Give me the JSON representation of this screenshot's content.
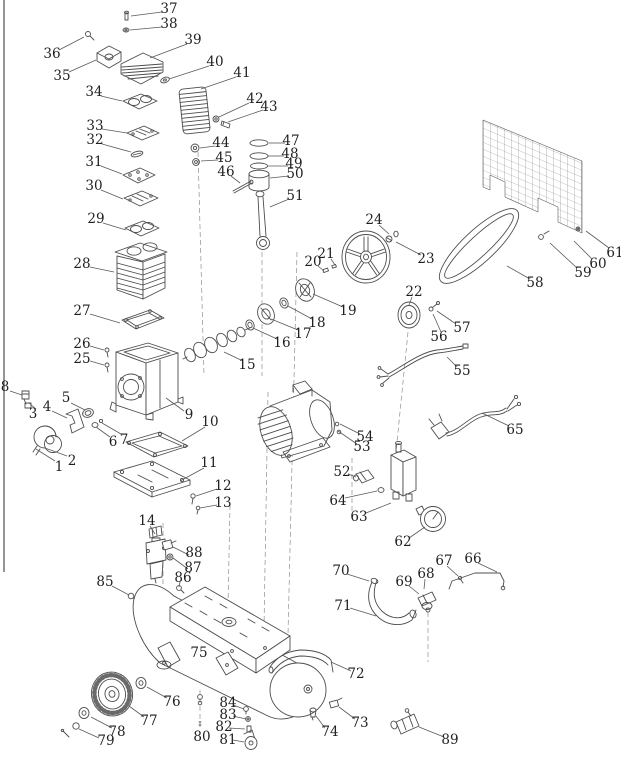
{
  "page": {
    "background": "#ffffff",
    "line_color": "#4d4d4d",
    "label_color": "#1f1f1f",
    "dash_color": "#8f8f8f",
    "border_color": "#7a7a7a"
  },
  "diagram": {
    "type": "exploded-parts-diagram",
    "subject": "air compressor parts breakdown",
    "part_count": 89,
    "labels": [
      {
        "n": "1",
        "x": 59,
        "y": 467,
        "leader": [
          55,
          461,
          36,
          449
        ]
      },
      {
        "n": "2",
        "x": 72,
        "y": 461,
        "leader": [
          67,
          456,
          45,
          448
        ]
      },
      {
        "n": "3",
        "x": 33,
        "y": 414,
        "leader": [
          36,
          409,
          29,
          403
        ]
      },
      {
        "n": "4",
        "x": 47,
        "y": 407,
        "leader": [
          52,
          411,
          67,
          418
        ]
      },
      {
        "n": "5",
        "x": 66,
        "y": 398,
        "leader": [
          71,
          403,
          85,
          410
        ]
      },
      {
        "n": "6",
        "x": 113,
        "y": 442,
        "leader": [
          110,
          437,
          96,
          427
        ]
      },
      {
        "n": "7",
        "x": 124,
        "y": 440,
        "leader": [
          121,
          434,
          102,
          423
        ]
      },
      {
        "n": "8",
        "x": 5,
        "y": 387,
        "leader": [
          10,
          391,
          22,
          395
        ]
      },
      {
        "n": "9",
        "x": 189,
        "y": 415,
        "leader": [
          184,
          411,
          166,
          398
        ]
      },
      {
        "n": "10",
        "x": 210,
        "y": 422,
        "leader": [
          205,
          427,
          182,
          441
        ]
      },
      {
        "n": "11",
        "x": 209,
        "y": 463,
        "leader": [
          204,
          468,
          180,
          481
        ]
      },
      {
        "n": "12",
        "x": 223,
        "y": 486,
        "leader": [
          217,
          489,
          196,
          496
        ]
      },
      {
        "n": "13",
        "x": 223,
        "y": 503,
        "leader": [
          217,
          505,
          200,
          508
        ]
      },
      {
        "n": "14",
        "x": 147,
        "y": 521,
        "leader": [
          150,
          526,
          155,
          534
        ]
      },
      {
        "n": "15",
        "x": 247,
        "y": 365,
        "leader": [
          243,
          361,
          224,
          352
        ]
      },
      {
        "n": "16",
        "x": 282,
        "y": 343,
        "leader": [
          277,
          339,
          253,
          328
        ]
      },
      {
        "n": "17",
        "x": 303,
        "y": 334,
        "leader": [
          298,
          330,
          271,
          319
        ]
      },
      {
        "n": "18",
        "x": 317,
        "y": 323,
        "leader": [
          312,
          319,
          288,
          306
        ]
      },
      {
        "n": "19",
        "x": 348,
        "y": 311,
        "leader": [
          343,
          307,
          313,
          294
        ]
      },
      {
        "n": "20",
        "x": 313,
        "y": 262,
        "leader": [
          318,
          266,
          324,
          271
        ]
      },
      {
        "n": "21",
        "x": 326,
        "y": 254,
        "leader": [
          331,
          259,
          335,
          265
        ]
      },
      {
        "n": "22",
        "x": 414,
        "y": 292,
        "leader": [
          412,
          297,
          409,
          305
        ]
      },
      {
        "n": "23",
        "x": 426,
        "y": 259,
        "leader": [
          421,
          255,
          396,
          242
        ]
      },
      {
        "n": "24",
        "x": 374,
        "y": 220,
        "leader": [
          379,
          225,
          389,
          234
        ]
      },
      {
        "n": "25",
        "x": 82,
        "y": 359,
        "leader": [
          90,
          361,
          104,
          365
        ]
      },
      {
        "n": "26",
        "x": 82,
        "y": 344,
        "leader": [
          90,
          346,
          104,
          350
        ]
      },
      {
        "n": "27",
        "x": 82,
        "y": 311,
        "leader": [
          90,
          314,
          120,
          323
        ]
      },
      {
        "n": "28",
        "x": 82,
        "y": 264,
        "leader": [
          90,
          267,
          114,
          272
        ]
      },
      {
        "n": "29",
        "x": 96,
        "y": 219,
        "leader": [
          103,
          223,
          126,
          230
        ]
      },
      {
        "n": "30",
        "x": 94,
        "y": 186,
        "leader": [
          101,
          190,
          123,
          199
        ]
      },
      {
        "n": "31",
        "x": 94,
        "y": 162,
        "leader": [
          101,
          166,
          122,
          174
        ]
      },
      {
        "n": "32",
        "x": 95,
        "y": 140,
        "leader": [
          102,
          144,
          131,
          152
        ]
      },
      {
        "n": "33",
        "x": 95,
        "y": 126,
        "leader": [
          102,
          129,
          127,
          133
        ]
      },
      {
        "n": "34",
        "x": 94,
        "y": 92,
        "leader": [
          101,
          96,
          122,
          101
        ]
      },
      {
        "n": "35",
        "x": 62,
        "y": 76,
        "leader": [
          69,
          72,
          96,
          60
        ]
      },
      {
        "n": "36",
        "x": 52,
        "y": 54,
        "leader": [
          59,
          50,
          84,
          37
        ]
      },
      {
        "n": "37",
        "x": 169,
        "y": 9,
        "leader": [
          162,
          12,
          131,
          16
        ]
      },
      {
        "n": "38",
        "x": 169,
        "y": 24,
        "leader": [
          162,
          27,
          130,
          30
        ]
      },
      {
        "n": "39",
        "x": 193,
        "y": 40,
        "leader": [
          187,
          44,
          150,
          58
        ]
      },
      {
        "n": "40",
        "x": 215,
        "y": 62,
        "leader": [
          209,
          66,
          169,
          79
        ]
      },
      {
        "n": "41",
        "x": 242,
        "y": 73,
        "leader": [
          236,
          77,
          201,
          89
        ]
      },
      {
        "n": "42",
        "x": 255,
        "y": 99,
        "leader": [
          249,
          103,
          219,
          117
        ]
      },
      {
        "n": "43",
        "x": 269,
        "y": 107,
        "leader": [
          263,
          110,
          228,
          122
        ]
      },
      {
        "n": "44",
        "x": 221,
        "y": 143,
        "leader": [
          215,
          146,
          200,
          148
        ]
      },
      {
        "n": "45",
        "x": 224,
        "y": 158,
        "leader": [
          218,
          160,
          201,
          161
        ]
      },
      {
        "n": "46",
        "x": 226,
        "y": 172,
        "leader": [
          231,
          176,
          240,
          183
        ]
      },
      {
        "n": "47",
        "x": 291,
        "y": 141,
        "leader": [
          285,
          143,
          269,
          143
        ]
      },
      {
        "n": "48",
        "x": 290,
        "y": 154,
        "leader": [
          284,
          156,
          268,
          156
        ]
      },
      {
        "n": "49",
        "x": 294,
        "y": 164,
        "leader": [
          288,
          166,
          268,
          166
        ]
      },
      {
        "n": "50",
        "x": 295,
        "y": 174,
        "leader": [
          289,
          176,
          270,
          178
        ]
      },
      {
        "n": "51",
        "x": 295,
        "y": 196,
        "leader": [
          289,
          199,
          270,
          207
        ]
      },
      {
        "n": "52",
        "x": 342,
        "y": 472,
        "leader": [
          348,
          474,
          356,
          477
        ]
      },
      {
        "n": "53",
        "x": 362,
        "y": 447,
        "leader": [
          357,
          444,
          338,
          431
        ]
      },
      {
        "n": "54",
        "x": 365,
        "y": 437,
        "leader": [
          360,
          434,
          340,
          424
        ]
      },
      {
        "n": "55",
        "x": 462,
        "y": 371,
        "leader": [
          457,
          367,
          447,
          357
        ]
      },
      {
        "n": "56",
        "x": 439,
        "y": 337,
        "leader": [
          441,
          332,
          433,
          314
        ]
      },
      {
        "n": "57",
        "x": 462,
        "y": 328,
        "leader": [
          456,
          324,
          437,
          311
        ]
      },
      {
        "n": "58",
        "x": 535,
        "y": 283,
        "leader": [
          530,
          279,
          507,
          266
        ]
      },
      {
        "n": "59",
        "x": 583,
        "y": 273,
        "leader": [
          577,
          268,
          550,
          243
        ]
      },
      {
        "n": "60",
        "x": 598,
        "y": 264,
        "leader": [
          592,
          259,
          574,
          241
        ]
      },
      {
        "n": "61",
        "x": 615,
        "y": 253,
        "leader": [
          609,
          248,
          586,
          231
        ]
      },
      {
        "n": "62",
        "x": 403,
        "y": 542,
        "leader": [
          409,
          538,
          425,
          527
        ]
      },
      {
        "n": "63",
        "x": 359,
        "y": 517,
        "leader": [
          366,
          513,
          391,
          503
        ]
      },
      {
        "n": "64",
        "x": 338,
        "y": 501,
        "leader": [
          345,
          498,
          377,
          491
        ]
      },
      {
        "n": "65",
        "x": 515,
        "y": 430,
        "leader": [
          509,
          426,
          482,
          413
        ]
      },
      {
        "n": "66",
        "x": 473,
        "y": 559,
        "leader": [
          478,
          563,
          497,
          572
        ]
      },
      {
        "n": "67",
        "x": 444,
        "y": 561,
        "leader": [
          447,
          566,
          458,
          576
        ]
      },
      {
        "n": "68",
        "x": 426,
        "y": 574,
        "leader": [
          425,
          579,
          424,
          589
        ]
      },
      {
        "n": "69",
        "x": 404,
        "y": 582,
        "leader": [
          409,
          586,
          419,
          594
        ]
      },
      {
        "n": "70",
        "x": 341,
        "y": 571,
        "leader": [
          347,
          574,
          369,
          581
        ]
      },
      {
        "n": "71",
        "x": 343,
        "y": 606,
        "leader": [
          350,
          608,
          376,
          616
        ]
      },
      {
        "n": "72",
        "x": 356,
        "y": 674,
        "leader": [
          351,
          671,
          331,
          662
        ]
      },
      {
        "n": "73",
        "x": 360,
        "y": 723,
        "leader": [
          355,
          719,
          339,
          707
        ]
      },
      {
        "n": "74",
        "x": 330,
        "y": 732,
        "leader": [
          325,
          728,
          316,
          716
        ]
      },
      {
        "n": "75",
        "x": 199,
        "y": 653
      },
      {
        "n": "76",
        "x": 172,
        "y": 702,
        "leader": [
          167,
          698,
          147,
          687
        ]
      },
      {
        "n": "77",
        "x": 149,
        "y": 721,
        "leader": [
          144,
          717,
          129,
          706
        ]
      },
      {
        "n": "78",
        "x": 117,
        "y": 732,
        "leader": [
          112,
          728,
          91,
          717
        ]
      },
      {
        "n": "79",
        "x": 106,
        "y": 741,
        "leader": [
          99,
          738,
          79,
          729
        ]
      },
      {
        "n": "80",
        "x": 202,
        "y": 737
      },
      {
        "n": "81",
        "x": 228,
        "y": 740,
        "leader": [
          233,
          740,
          244,
          742
        ]
      },
      {
        "n": "82",
        "x": 224,
        "y": 727,
        "leader": [
          229,
          728,
          245,
          729
        ]
      },
      {
        "n": "83",
        "x": 228,
        "y": 715,
        "leader": [
          233,
          716,
          246,
          719
        ]
      },
      {
        "n": "84",
        "x": 228,
        "y": 703,
        "leader": [
          233,
          705,
          244,
          709
        ]
      },
      {
        "n": "85",
        "x": 105,
        "y": 582,
        "leader": [
          112,
          586,
          129,
          595
        ]
      },
      {
        "n": "86",
        "x": 183,
        "y": 578,
        "leader": [
          180,
          582,
          179,
          587
        ]
      },
      {
        "n": "87",
        "x": 193,
        "y": 568,
        "leader": [
          188,
          569,
          173,
          558
        ]
      },
      {
        "n": "88",
        "x": 194,
        "y": 553,
        "leader": [
          189,
          555,
          173,
          547
        ]
      },
      {
        "n": "89",
        "x": 450,
        "y": 740,
        "leader": [
          444,
          737,
          419,
          727
        ]
      }
    ]
  }
}
